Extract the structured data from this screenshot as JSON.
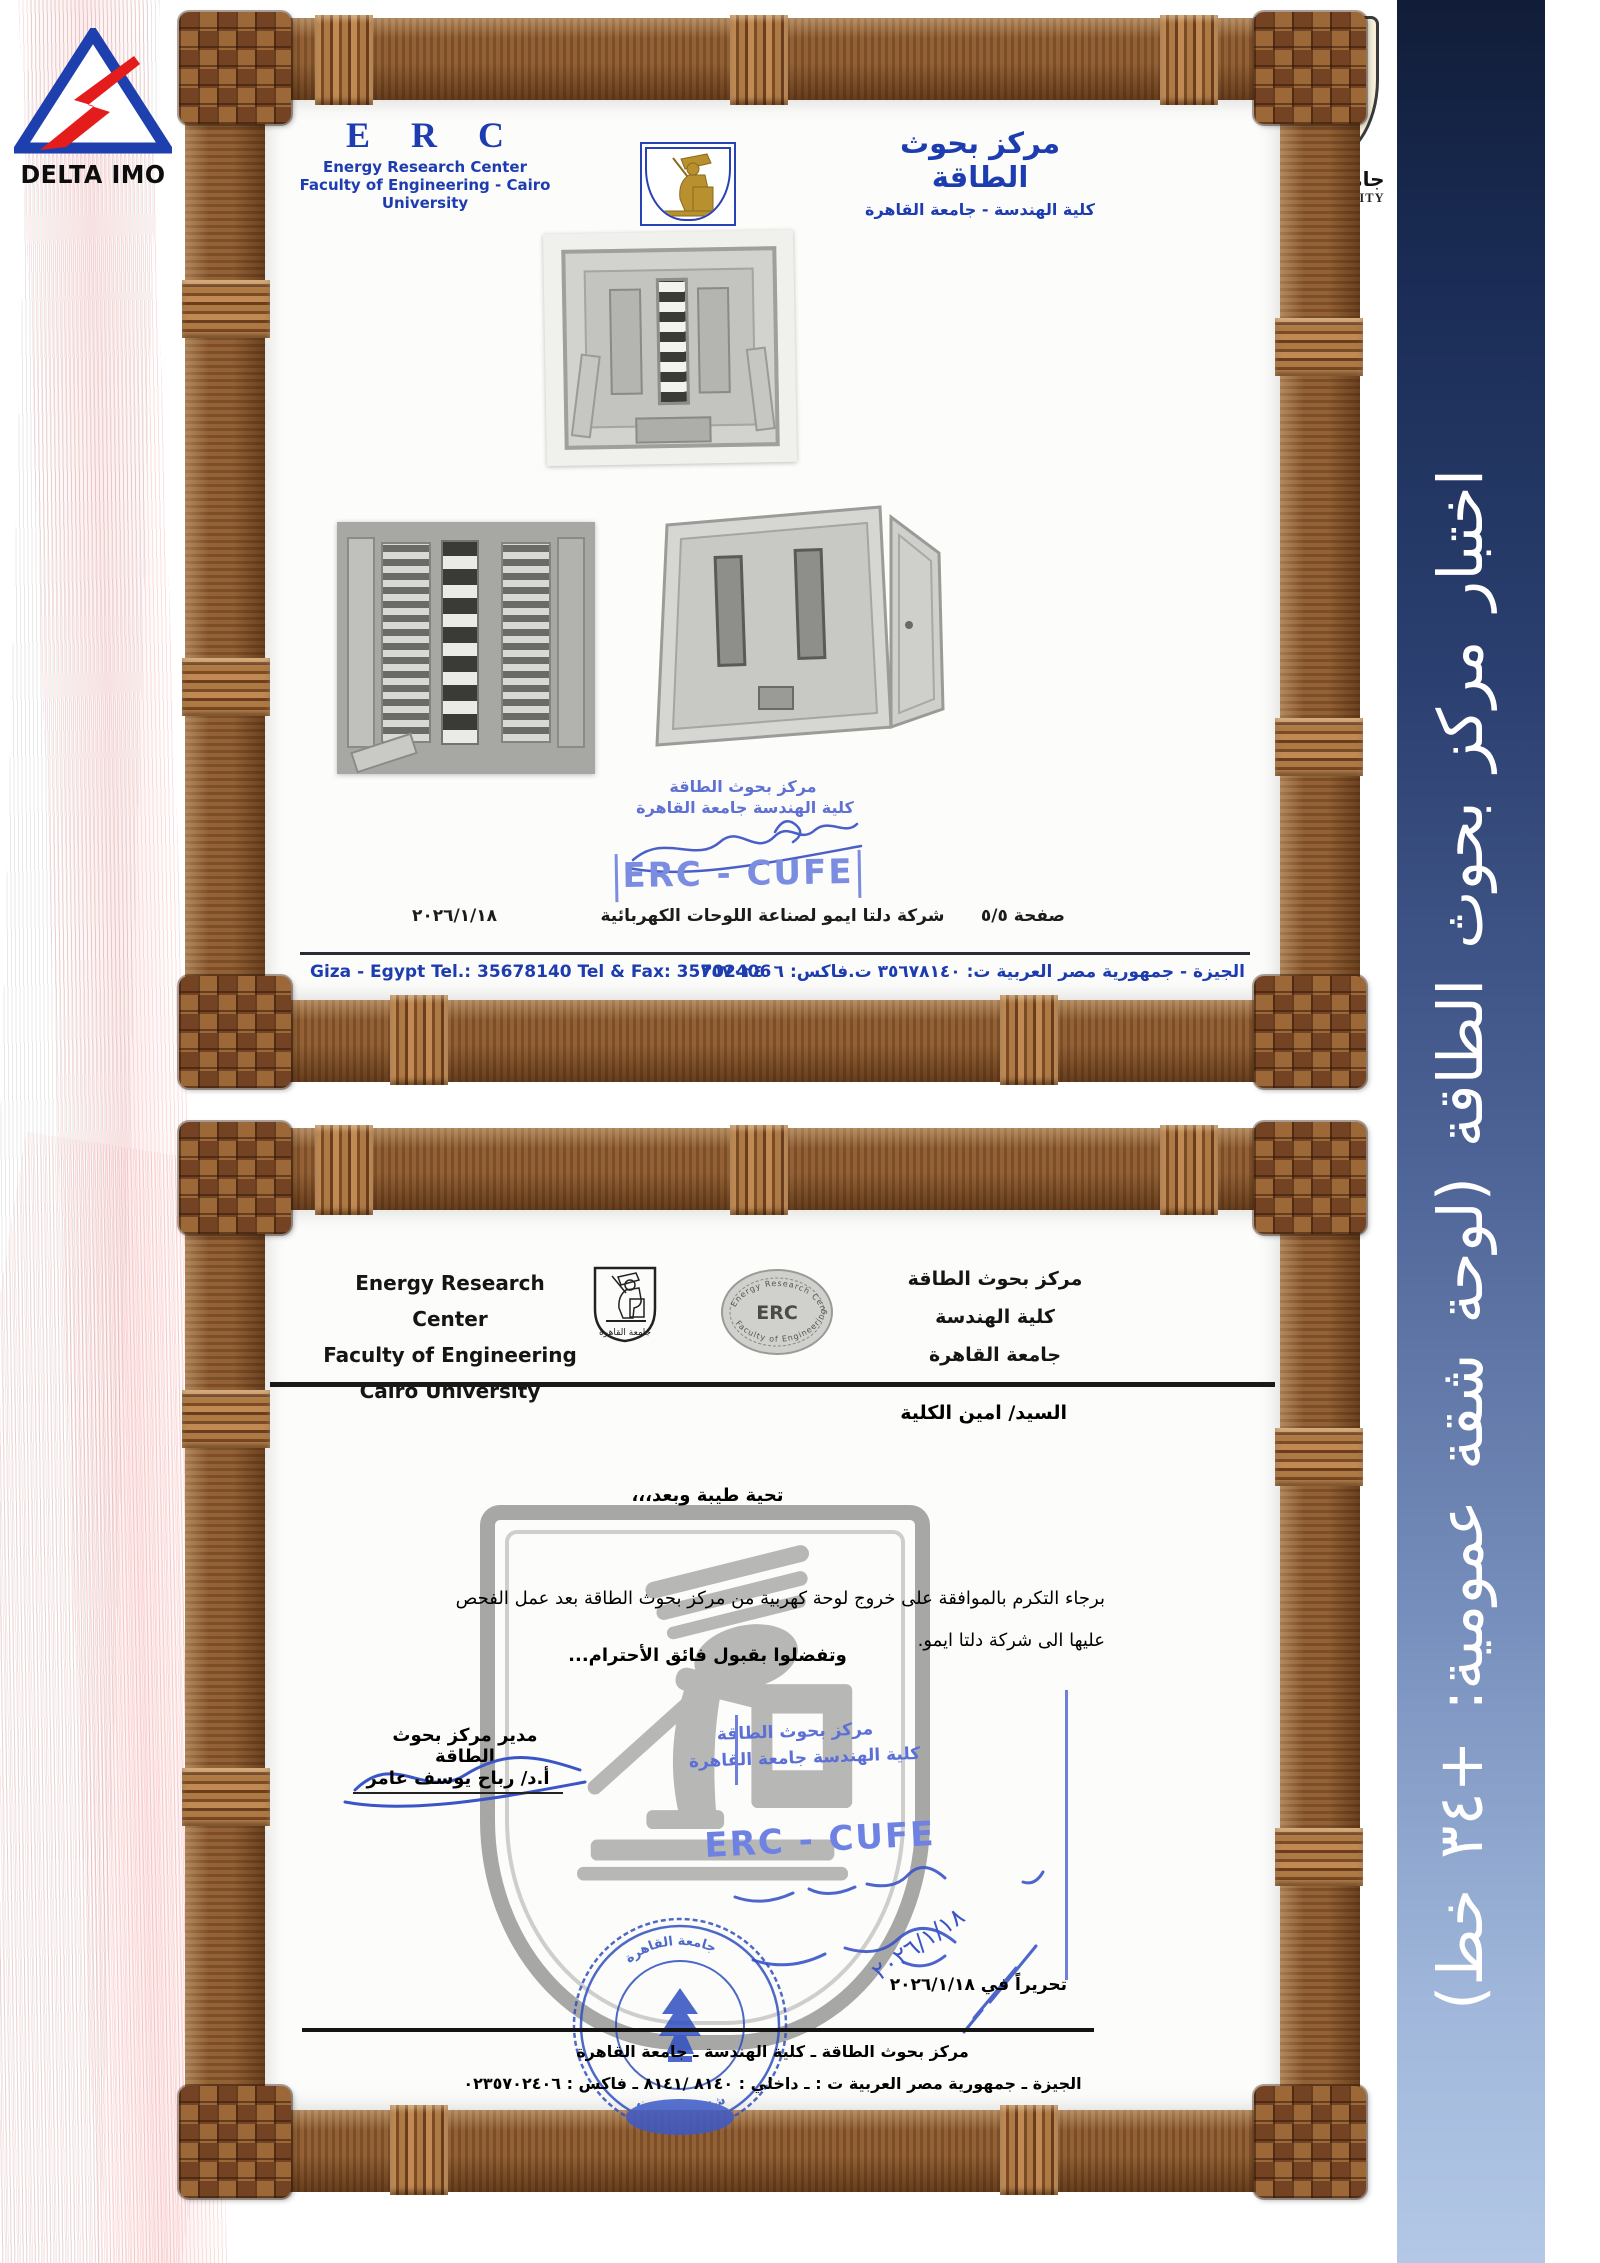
{
  "colors": {
    "banner_top": "#111d38",
    "banner_bottom": "#b3c8e6",
    "erc_blue": "#1d3cb0",
    "stamp_blue": "#5f71d2",
    "wood_brown": "#8a5a30",
    "delta_red": "#e41c1c",
    "delta_blue": "#1e3fae"
  },
  "sidebar": {
    "vertical_text": "اختبار مركز بحوث الطاقة (لوحة شقة عمومية: +٣٤ خط)"
  },
  "delta_logo": {
    "label": "DELTA IMO"
  },
  "cairo_logo": {
    "arabic_name": "جامعة القاهرة",
    "english_name": "CAIRO UNIVERSITY"
  },
  "cert1": {
    "erc_acronym": "E R C",
    "center_name_en": "Energy Research Center",
    "faculty_line_en": "Faculty of Engineering - Cairo University",
    "center_name_ar": "مركز بحوث الطاقة",
    "faculty_line_ar": "كلية الهندسة - جامعة القاهرة",
    "stamp": {
      "line1": "مركز بحوث الطاقة",
      "line2": "كلية الهندسة   جامعة القاهرة",
      "code": "ERC - CUFE"
    },
    "date": "٢٠٢٦/١/١٨",
    "company_line": "شركة دلتا ايمو لصناعة اللوحات الكهربائية",
    "page_label": "صفحة ٥/٥",
    "contact_en": "Giza - Egypt Tel.: 35678140 Tel & Fax: 35702406",
    "contact_ar": "الجيزة - جمهورية مصر العربية ت: ٣٥٦٧٨١٤٠  ت.فاكس: ٣٥٧٠٢٤٠٦"
  },
  "cert2": {
    "header_en": {
      "line1": "Energy Research Center",
      "line2": "Faculty of Engineering",
      "line3": "Cairo University"
    },
    "header_ar": {
      "line1": "مركز بحوث الطاقة",
      "line2": "كلية الهندسة",
      "line3": "جامعة القاهرة"
    },
    "seal": {
      "top": "Energy Research Center",
      "center": "ERC",
      "bottom": "Faculty of Engineering"
    },
    "shield_caption": "جامعة القاهرة",
    "recipient": "السيد/ امين الكلية",
    "greeting": "تحية طيبة وبعد،،،",
    "body_line1": "برجاء التكرم بالموافقة على خروج لوحة كهربية من مركز بحوث الطاقة بعد عمل الفحص",
    "body_line2": "عليها الى شركة دلتا ايمو.",
    "closing": "وتفضلوا بقبول فائق الأحترام...",
    "signer_title": "مدير مركز بحوث الطاقة",
    "signer_name": "أ.د/ رباح يوسف عامر",
    "stamp": {
      "line1": "مركز بحوث الطاقة",
      "line2": "كلية الهندسة   جامعة القاهرة",
      "code": "ERC - CUFE"
    },
    "handwritten_date": "٢٠٢٦/١/١٨",
    "round_stamp_ring": "جامعة القاهرة",
    "round_stamp_caption": "شئون العاملين",
    "issue_date_line": "تحريراً في ٢٠٢٦/١/١٨",
    "footer_line1": "مركز بحوث الطاقة ـ كلية الهندسة ـ جامعة القاهرة",
    "footer_line2": "الجيزة ـ جمهورية مصر العربية ت : ـ داخلي : ٨١٤٠ /٨١٤١ ـ فاكس : ٠٢٣٥٧٠٢٤٠٦"
  }
}
